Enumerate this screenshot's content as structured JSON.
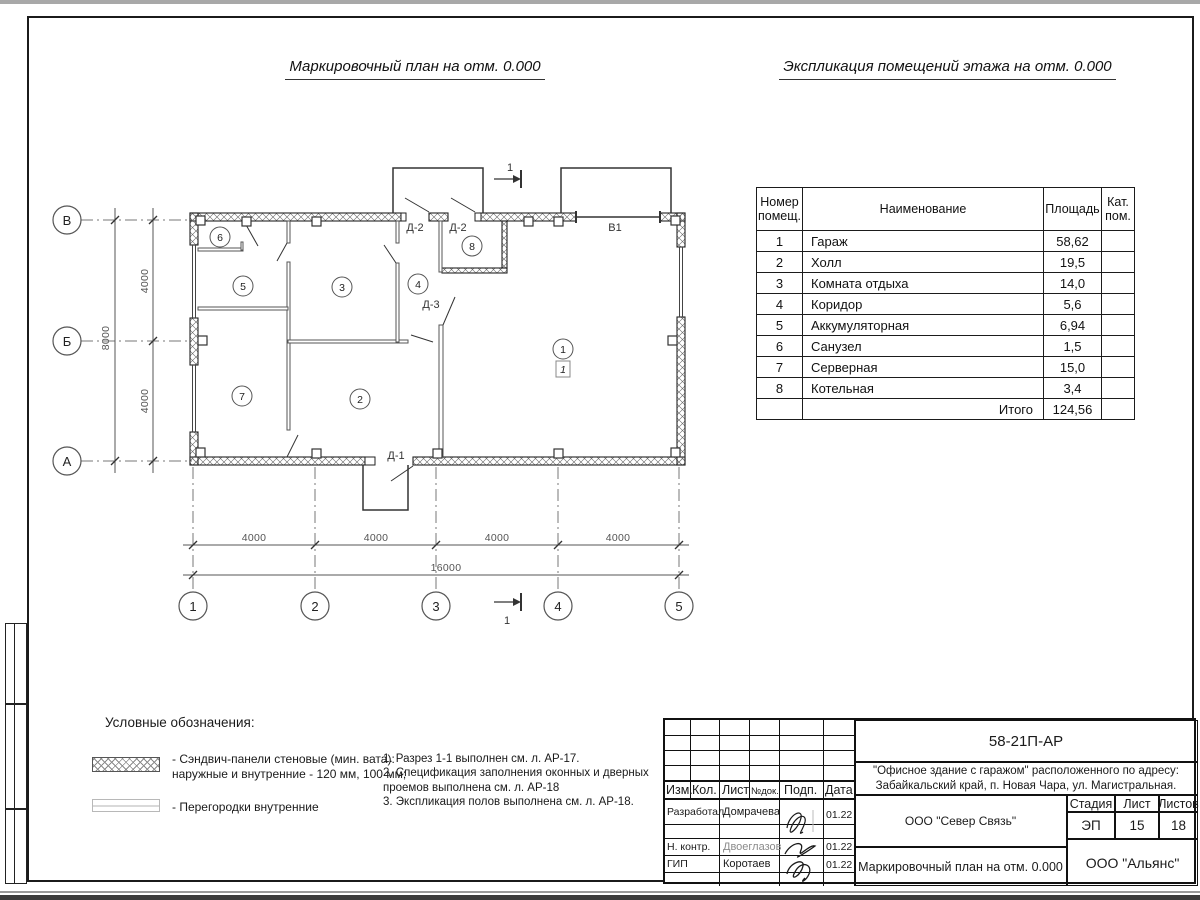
{
  "titles": {
    "plan_title": "Маркировочный план на отм. 0.000",
    "explication_title": "Экспликация помещений этажа на отм. 0.000"
  },
  "plan": {
    "axes_cols": [
      "1",
      "2",
      "3",
      "4",
      "5"
    ],
    "axes_rows": [
      "В",
      "Б",
      "А"
    ],
    "dims_bottom": [
      "4000",
      "4000",
      "4000",
      "4000"
    ],
    "total_bottom": "16000",
    "dims_left": [
      "4000",
      "4000"
    ],
    "total_left": "8000",
    "rooms": [
      "1",
      "2",
      "3",
      "4",
      "5",
      "6",
      "7",
      "8"
    ],
    "floor_mark": "1",
    "door_labels": [
      "Д-2",
      "Д-2",
      "Д-3",
      "Д-1"
    ],
    "gate_label": "В1",
    "section_label": "1"
  },
  "explication": {
    "headers": {
      "num": "Номер помещ.",
      "name": "Наименование",
      "area": "Площадь",
      "cat": "Кат. пом."
    },
    "rows": [
      {
        "num": "1",
        "name": "Гараж",
        "area": "58,62"
      },
      {
        "num": "2",
        "name": "Холл",
        "area": "19,5"
      },
      {
        "num": "3",
        "name": "Комната отдыха",
        "area": "14,0"
      },
      {
        "num": "4",
        "name": "Коридор",
        "area": "5,6"
      },
      {
        "num": "5",
        "name": "Аккумуляторная",
        "area": "6,94"
      },
      {
        "num": "6",
        "name": "Санузел",
        "area": "1,5"
      },
      {
        "num": "7",
        "name": "Серверная",
        "area": "15,0"
      },
      {
        "num": "8",
        "name": "Котельная",
        "area": "3,4"
      }
    ],
    "total_label": "Итого",
    "total_area": "124,56"
  },
  "legend": {
    "title": "Условные обозначения:",
    "items": [
      {
        "text": "- Сэндвич-панели стеновые (мин. вата):\nнаружные и внутренние - 120 мм, 100 мм;"
      },
      {
        "text": "- Перегородки внутренние"
      }
    ]
  },
  "notes": [
    "1. Разрез 1-1 выполнен см. л. АР-17.",
    "2. Спецификация заполнения оконных и дверных проемов выполнена см. л. АР-18",
    "3. Экспликация полов выполнена см. л. АР-18."
  ],
  "titleblock": {
    "doc_number": "58-21П-АР",
    "object_lines": "\"Офисное здание с гаражом\" расположенного по адресу:\nЗабайкальский край, п. Новая Чара, ул. Магистральная.",
    "header_cols": {
      "izm": "Изм.",
      "kol": "Кол.",
      "list": "Лист",
      "ndok": "№док.",
      "podp": "Подп.",
      "data": "Дата"
    },
    "rows": [
      {
        "role": "Разработал",
        "name": "Домрачева",
        "date": "01.22"
      },
      {
        "role": "Н. контр.",
        "name": "Двоеглазов",
        "date": "01.22"
      },
      {
        "role": "ГИП",
        "name": "Коротаев",
        "date": "01.22"
      }
    ],
    "company": "ООО \"Север Связь\"",
    "stage_label": "Стадия",
    "sheet_label": "Лист",
    "sheets_label": "Листов",
    "stage": "ЭП",
    "sheet": "15",
    "sheets": "18",
    "sheet_title": "Маркировочный план на отм. 0.000",
    "company2": "ООО \"Альянс\""
  }
}
